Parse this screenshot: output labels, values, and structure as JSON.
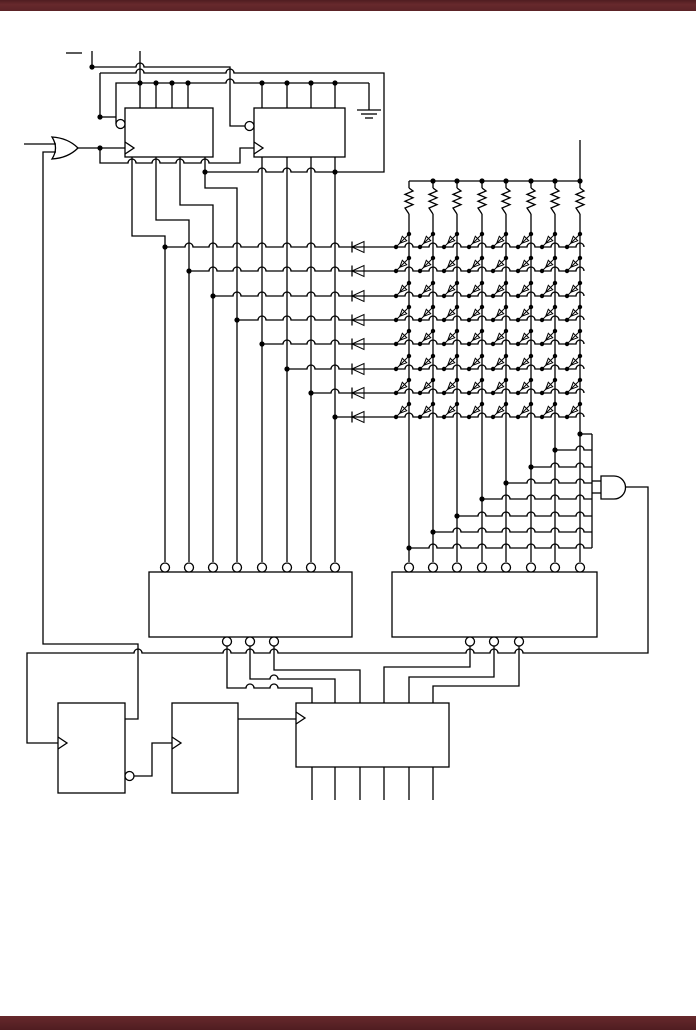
{
  "canvas": {
    "width": 696,
    "height": 1034,
    "background": "#ffffff"
  },
  "bars": {
    "top": {
      "y": 0,
      "height": 11,
      "color": "#5b2327"
    },
    "bottom": {
      "y": 1016,
      "height": 14,
      "color": "#5b2327"
    }
  },
  "style": {
    "line_color": "#000000",
    "line_width": 1.3,
    "dot_radius": 2.6,
    "bubble_radius": 4.5,
    "hop_radius": 4
  },
  "boxes": [
    {
      "id": "register-1",
      "x": 125,
      "y": 108,
      "w": 88,
      "h": 49,
      "clock_y": 148,
      "left_bubble": {
        "x": 120.5,
        "y": 124
      }
    },
    {
      "id": "register-2",
      "x": 254,
      "y": 108,
      "w": 91,
      "h": 49,
      "clock_y": 148,
      "left_bubble": {
        "x": 249.5,
        "y": 126
      }
    },
    {
      "id": "decoder-left",
      "x": 149,
      "y": 572,
      "w": 203,
      "h": 65,
      "top_bubbles": [
        165,
        189,
        213,
        237,
        262,
        287,
        311,
        335
      ],
      "bottom_bubbles": [
        227,
        250,
        274
      ]
    },
    {
      "id": "decoder-right",
      "x": 392,
      "y": 572,
      "w": 205,
      "h": 65,
      "top_bubbles": [
        409,
        433,
        457,
        482,
        506,
        531,
        555,
        580
      ],
      "bottom_bubbles": [
        470,
        494,
        519
      ]
    },
    {
      "id": "flipflop-1",
      "x": 58,
      "y": 703,
      "w": 67,
      "h": 90,
      "clock_y": 743,
      "right_bubble": {
        "x": 129.5,
        "y": 776
      }
    },
    {
      "id": "flipflop-2",
      "x": 172,
      "y": 703,
      "w": 66,
      "h": 90,
      "clock_y": 743
    },
    {
      "id": "counter-box",
      "x": 296,
      "y": 703,
      "w": 153,
      "h": 64,
      "clock_y": 718
    }
  ],
  "or_gate": {
    "x": 52,
    "y": 148,
    "w": 26,
    "h": 24
  },
  "and_gate": {
    "x": 601,
    "y": 476,
    "w": 26,
    "h": 23
  },
  "ground": {
    "x": 369,
    "y": 110
  },
  "matrix": {
    "cols": [
      409,
      433,
      457,
      482,
      506,
      531,
      555,
      580
    ],
    "rows": [
      247,
      271,
      296,
      320,
      344,
      369,
      393,
      417
    ],
    "verts": [
      165,
      189,
      213,
      237,
      262,
      287,
      311,
      335
    ],
    "rail_y": 181,
    "res_top": 188,
    "res_bot": 214,
    "col_bottom": 562,
    "row_diode_x": 352,
    "row_end": 584,
    "power_stub_top": 140,
    "diag_dx": 13,
    "diag_dy": 13,
    "tap_ys": [
      548,
      532,
      516,
      499,
      483,
      467,
      450,
      434
    ],
    "tap_bus_x": 592,
    "tap_bus_top": 434,
    "tap_bus_bottom": 548,
    "and_stub_ys": [
      481,
      493
    ]
  },
  "wires": [
    {
      "n": "input-label-bar",
      "pts": [
        [
          66,
          53
        ],
        [
          82,
          53
        ]
      ]
    },
    {
      "n": "top-stub",
      "pts": [
        [
          92,
          51
        ],
        [
          92,
          67
        ]
      ]
    },
    {
      "n": "preset-run-a",
      "pts": [
        [
          92,
          67
        ],
        [
          230,
          67
        ],
        [
          230,
          126
        ],
        [
          245,
          126
        ]
      ],
      "hops": [
        [
          140,
          67
        ]
      ]
    },
    {
      "n": "preset-run-b",
      "pts": [
        [
          100,
          73
        ],
        [
          384,
          73
        ],
        [
          384,
          172
        ],
        [
          205,
          172
        ]
      ],
      "hops": [
        [
          140,
          73
        ],
        [
          230,
          73
        ],
        [
          311,
          172
        ],
        [
          287,
          172
        ],
        [
          262,
          172
        ]
      ]
    },
    {
      "n": "preset-drop",
      "pts": [
        [
          100,
          73
        ],
        [
          100,
          117
        ]
      ]
    },
    {
      "n": "enable-rail",
      "pts": [
        [
          369,
          83
        ],
        [
          116,
          83
        ],
        [
          116,
          124
        ]
      ],
      "hops": [
        [
          230,
          83
        ]
      ]
    },
    {
      "n": "bubble-link",
      "pts": [
        [
          100,
          117
        ],
        [
          116,
          117
        ]
      ]
    },
    {
      "n": "or-output",
      "pts": [
        [
          78,
          148
        ],
        [
          125,
          148
        ]
      ]
    },
    {
      "n": "clock2-route",
      "pts": [
        [
          100,
          148
        ],
        [
          100,
          163
        ],
        [
          240,
          163
        ],
        [
          240,
          148
        ],
        [
          254,
          148
        ]
      ],
      "hops": [
        [
          132,
          163
        ],
        [
          156,
          163
        ],
        [
          180,
          163
        ],
        [
          205,
          163
        ]
      ]
    },
    {
      "n": "or-input-1",
      "pts": [
        [
          24,
          144
        ],
        [
          56,
          144
        ]
      ]
    },
    {
      "n": "or-input-2-feedback",
      "pts": [
        [
          56,
          152
        ],
        [
          43,
          152
        ],
        [
          43,
          644
        ],
        [
          138,
          644
        ],
        [
          138,
          719
        ],
        [
          125,
          719
        ]
      ]
    },
    {
      "n": "reg1-top-in",
      "pts": [
        [
          140,
          51
        ],
        [
          140,
          108
        ]
      ]
    },
    {
      "n": "reg1-top-stub",
      "pts": [
        [
          156,
          83
        ],
        [
          156,
          108
        ]
      ]
    },
    {
      "n": "reg1-top-stub",
      "pts": [
        [
          172,
          83
        ],
        [
          172,
          108
        ]
      ]
    },
    {
      "n": "reg1-top-stub",
      "pts": [
        [
          188,
          83
        ],
        [
          188,
          108
        ]
      ]
    },
    {
      "n": "reg2-top-stub",
      "pts": [
        [
          262,
          83
        ],
        [
          262,
          108
        ]
      ]
    },
    {
      "n": "reg2-top-stub",
      "pts": [
        [
          287,
          83
        ],
        [
          287,
          108
        ]
      ]
    },
    {
      "n": "reg2-top-stub",
      "pts": [
        [
          311,
          83
        ],
        [
          311,
          108
        ]
      ]
    },
    {
      "n": "reg2-top-stub",
      "pts": [
        [
          335,
          83
        ],
        [
          335,
          108
        ]
      ]
    },
    {
      "n": "ground-stem",
      "pts": [
        [
          369,
          83
        ],
        [
          369,
          110
        ]
      ]
    },
    {
      "n": "reg1-out-1",
      "pts": [
        [
          132,
          157
        ],
        [
          132,
          236
        ],
        [
          165,
          236
        ],
        [
          165,
          562
        ]
      ]
    },
    {
      "n": "reg1-out-2",
      "pts": [
        [
          156,
          157
        ],
        [
          156,
          220
        ],
        [
          189,
          220
        ],
        [
          189,
          562
        ]
      ]
    },
    {
      "n": "reg1-out-3",
      "pts": [
        [
          180,
          157
        ],
        [
          180,
          205
        ],
        [
          213,
          205
        ],
        [
          213,
          562
        ]
      ]
    },
    {
      "n": "reg1-out-4",
      "pts": [
        [
          205,
          157
        ],
        [
          205,
          188
        ],
        [
          237,
          188
        ],
        [
          237,
          562
        ]
      ]
    },
    {
      "n": "reg2-out-1",
      "pts": [
        [
          262,
          157
        ],
        [
          262,
          562
        ]
      ]
    },
    {
      "n": "reg2-out-2",
      "pts": [
        [
          287,
          157
        ],
        [
          287,
          562
        ]
      ]
    },
    {
      "n": "reg2-out-3",
      "pts": [
        [
          311,
          157
        ],
        [
          311,
          562
        ]
      ]
    },
    {
      "n": "reg2-out-4",
      "pts": [
        [
          335,
          157
        ],
        [
          335,
          562
        ]
      ]
    },
    {
      "n": "and-output-bus",
      "pts": [
        [
          626,
          487
        ],
        [
          648,
          487
        ],
        [
          648,
          653
        ],
        [
          27,
          653
        ],
        [
          27,
          743
        ],
        [
          58,
          743
        ]
      ],
      "hops": [
        [
          519,
          653
        ],
        [
          494,
          653
        ],
        [
          470,
          653
        ],
        [
          274,
          653
        ],
        [
          250,
          653
        ],
        [
          227,
          653
        ],
        [
          138,
          653
        ]
      ]
    },
    {
      "n": "ff1-out",
      "pts": [
        [
          134,
          776
        ],
        [
          152,
          776
        ],
        [
          152,
          743
        ],
        [
          172,
          743
        ]
      ]
    },
    {
      "n": "ff2-out",
      "pts": [
        [
          238,
          719
        ],
        [
          296,
          719
        ]
      ]
    },
    {
      "n": "sel-left-1",
      "pts": [
        [
          227,
          646
        ],
        [
          227,
          688
        ],
        [
          312,
          688
        ],
        [
          312,
          703
        ]
      ],
      "hops": [
        [
          250,
          688
        ],
        [
          274,
          688
        ]
      ]
    },
    {
      "n": "sel-left-2",
      "pts": [
        [
          250,
          646
        ],
        [
          250,
          679
        ],
        [
          335,
          679
        ],
        [
          335,
          703
        ]
      ],
      "hops": [
        [
          274,
          679
        ]
      ]
    },
    {
      "n": "sel-left-3",
      "pts": [
        [
          274,
          646
        ],
        [
          274,
          670
        ],
        [
          360,
          670
        ],
        [
          360,
          703
        ]
      ]
    },
    {
      "n": "sel-right-1",
      "pts": [
        [
          470,
          646
        ],
        [
          470,
          667
        ],
        [
          384,
          667
        ],
        [
          384,
          703
        ]
      ]
    },
    {
      "n": "sel-right-2",
      "pts": [
        [
          494,
          646
        ],
        [
          494,
          677
        ],
        [
          409,
          677
        ],
        [
          409,
          703
        ]
      ]
    },
    {
      "n": "sel-right-3",
      "pts": [
        [
          519,
          646
        ],
        [
          519,
          686
        ],
        [
          433,
          686
        ],
        [
          433,
          703
        ]
      ]
    },
    {
      "n": "counter-out",
      "pts": [
        [
          312,
          767
        ],
        [
          312,
          800
        ]
      ]
    },
    {
      "n": "counter-out",
      "pts": [
        [
          335,
          767
        ],
        [
          335,
          800
        ]
      ]
    },
    {
      "n": "counter-out",
      "pts": [
        [
          360,
          767
        ],
        [
          360,
          800
        ]
      ]
    },
    {
      "n": "counter-out",
      "pts": [
        [
          384,
          767
        ],
        [
          384,
          800
        ]
      ]
    },
    {
      "n": "counter-out",
      "pts": [
        [
          409,
          767
        ],
        [
          409,
          800
        ]
      ]
    },
    {
      "n": "counter-out",
      "pts": [
        [
          433,
          767
        ],
        [
          433,
          800
        ]
      ]
    }
  ],
  "dots": [
    [
      92,
      67
    ],
    [
      100,
      117
    ],
    [
      100,
      148
    ],
    [
      205,
      172
    ],
    [
      335,
      172
    ],
    [
      140,
      83
    ],
    [
      156,
      83
    ],
    [
      172,
      83
    ],
    [
      188,
      83
    ],
    [
      262,
      83
    ],
    [
      287,
      83
    ],
    [
      311,
      83
    ],
    [
      335,
      83
    ],
    [
      165,
      247
    ],
    [
      189,
      271
    ],
    [
      213,
      296
    ],
    [
      237,
      320
    ],
    [
      262,
      344
    ],
    [
      287,
      369
    ],
    [
      311,
      393
    ],
    [
      335,
      417
    ],
    [
      433,
      181
    ],
    [
      457,
      181
    ],
    [
      482,
      181
    ],
    [
      506,
      181
    ],
    [
      531,
      181
    ],
    [
      555,
      181
    ],
    [
      580,
      181
    ],
    [
      409,
      548
    ],
    [
      433,
      532
    ],
    [
      457,
      516
    ],
    [
      482,
      499
    ],
    [
      506,
      483
    ],
    [
      531,
      467
    ],
    [
      555,
      450
    ],
    [
      580,
      434
    ]
  ]
}
